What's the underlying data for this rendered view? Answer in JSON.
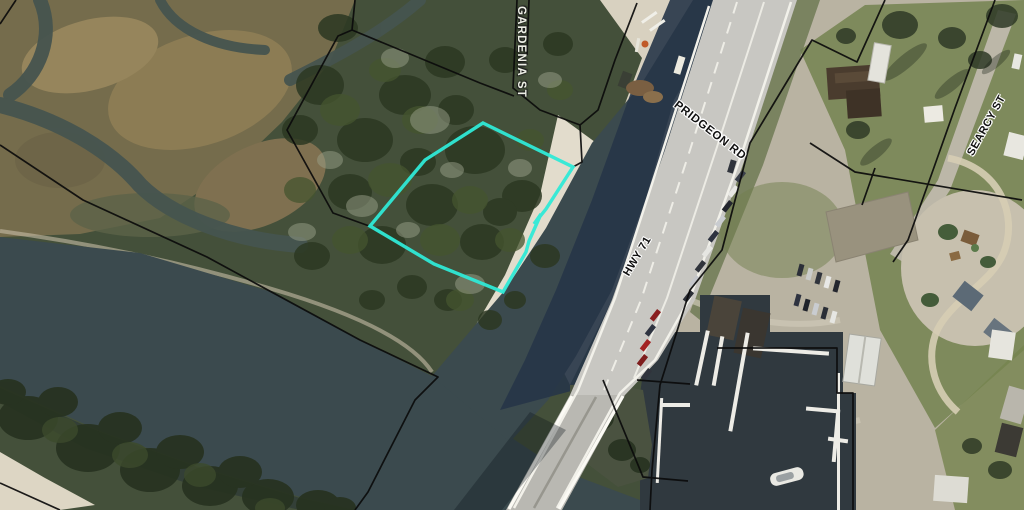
{
  "map": {
    "type": "aerial-parcel-map",
    "description": "Satellite photo with parcel boundary overlay and highlighted lot beside a highway bridge, river marsh and marina"
  },
  "labels": {
    "gardenia": "GARDENIA ST",
    "pridgeon": "PRIDGEON RD",
    "hwy": "HWY 71",
    "searcy": "SEARCY ST"
  },
  "colors": {
    "highlight": "#2fe9d6",
    "line": "#0b0b0b",
    "woods": "#44503a",
    "marsh": "#756c4c",
    "creek": "#46544f",
    "river": "#3b4a4e",
    "ditch": "#273548",
    "basin": "#30393f",
    "road": "#c8c7c2",
    "bridge": "#b9b8b2",
    "stripe": "#f2f1ea",
    "sand": "#d8d1c0",
    "beach": "#e2dccc",
    "pale": "#b9b3a2",
    "lawn": "#7e8a5c",
    "gravel": "#c7c0ae",
    "dock": "#edece6"
  }
}
